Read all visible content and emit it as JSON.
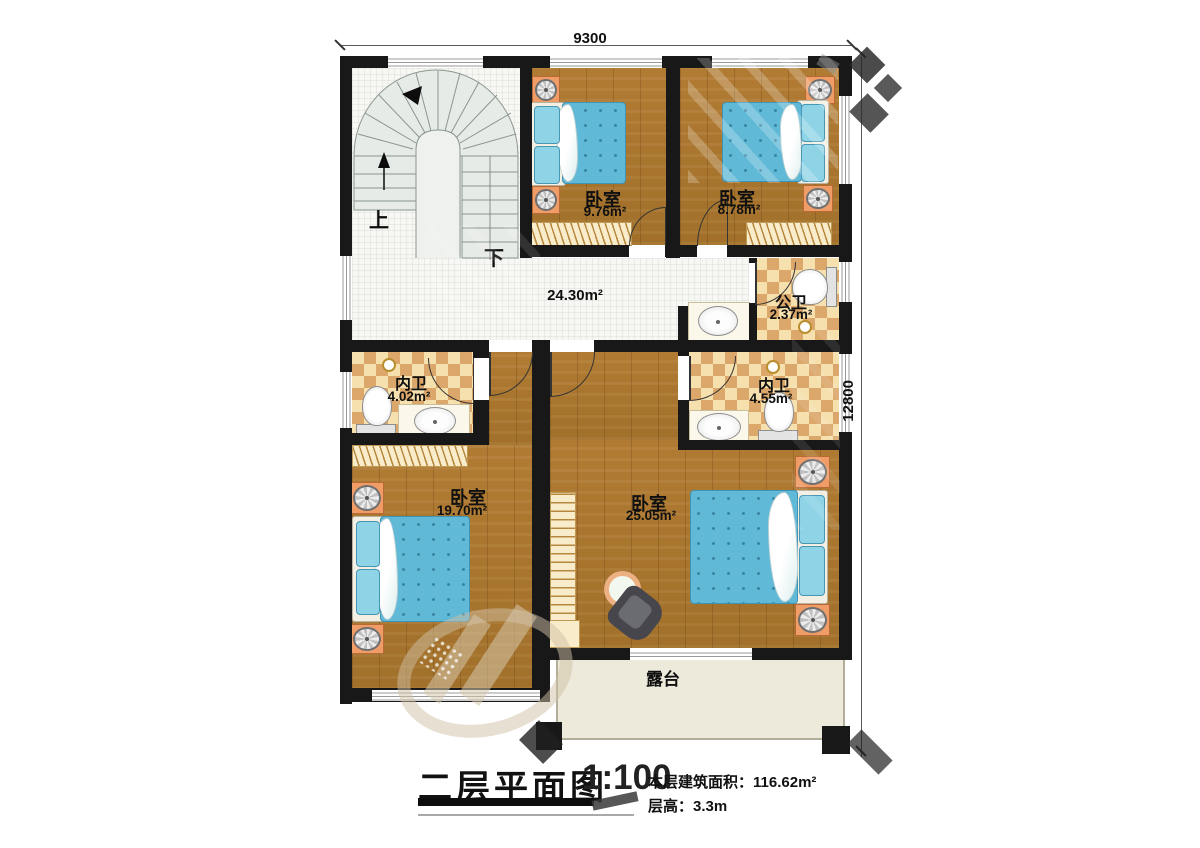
{
  "title": {
    "text": "二层平面图",
    "scale": "1:100"
  },
  "info": {
    "area_label": "本层建筑面积：",
    "area_value": "116.62m²",
    "height_label": "层高：",
    "height_value": "3.3m"
  },
  "dimensions": {
    "top": "9300",
    "right": "12800"
  },
  "rooms": {
    "bedroom_tl": {
      "name": "卧室",
      "area": "9.76m²"
    },
    "bedroom_tr": {
      "name": "卧室",
      "area": "8.78m²"
    },
    "bedroom_bl": {
      "name": "卧室",
      "area": "19.70m²"
    },
    "bedroom_br": {
      "name": "卧室",
      "area": "25.05m²"
    },
    "hall": {
      "area": "24.30m²"
    },
    "public_bath": {
      "name": "公卫",
      "area": "2.37m²"
    },
    "ensuite_left": {
      "name": "内卫",
      "area": "4.02m²"
    },
    "ensuite_right": {
      "name": "内卫",
      "area": "4.55m²"
    },
    "terrace": {
      "name": "露台"
    }
  },
  "stairs": {
    "up_label": "上",
    "down_label": "下"
  },
  "colors": {
    "wall": "#181818",
    "wood_floor": "#ab772f",
    "bathroom_tile_dark": "#dca76b",
    "bathroom_tile_light": "#f5e0ae",
    "hall_tile": "#f7f7f3",
    "terrace_tile": "#edeadb",
    "mattress": "#60b9d6",
    "pillow": "#8fd3e6",
    "nightstand": "#ef9c66",
    "stair_tread": "#e7ebe7"
  }
}
